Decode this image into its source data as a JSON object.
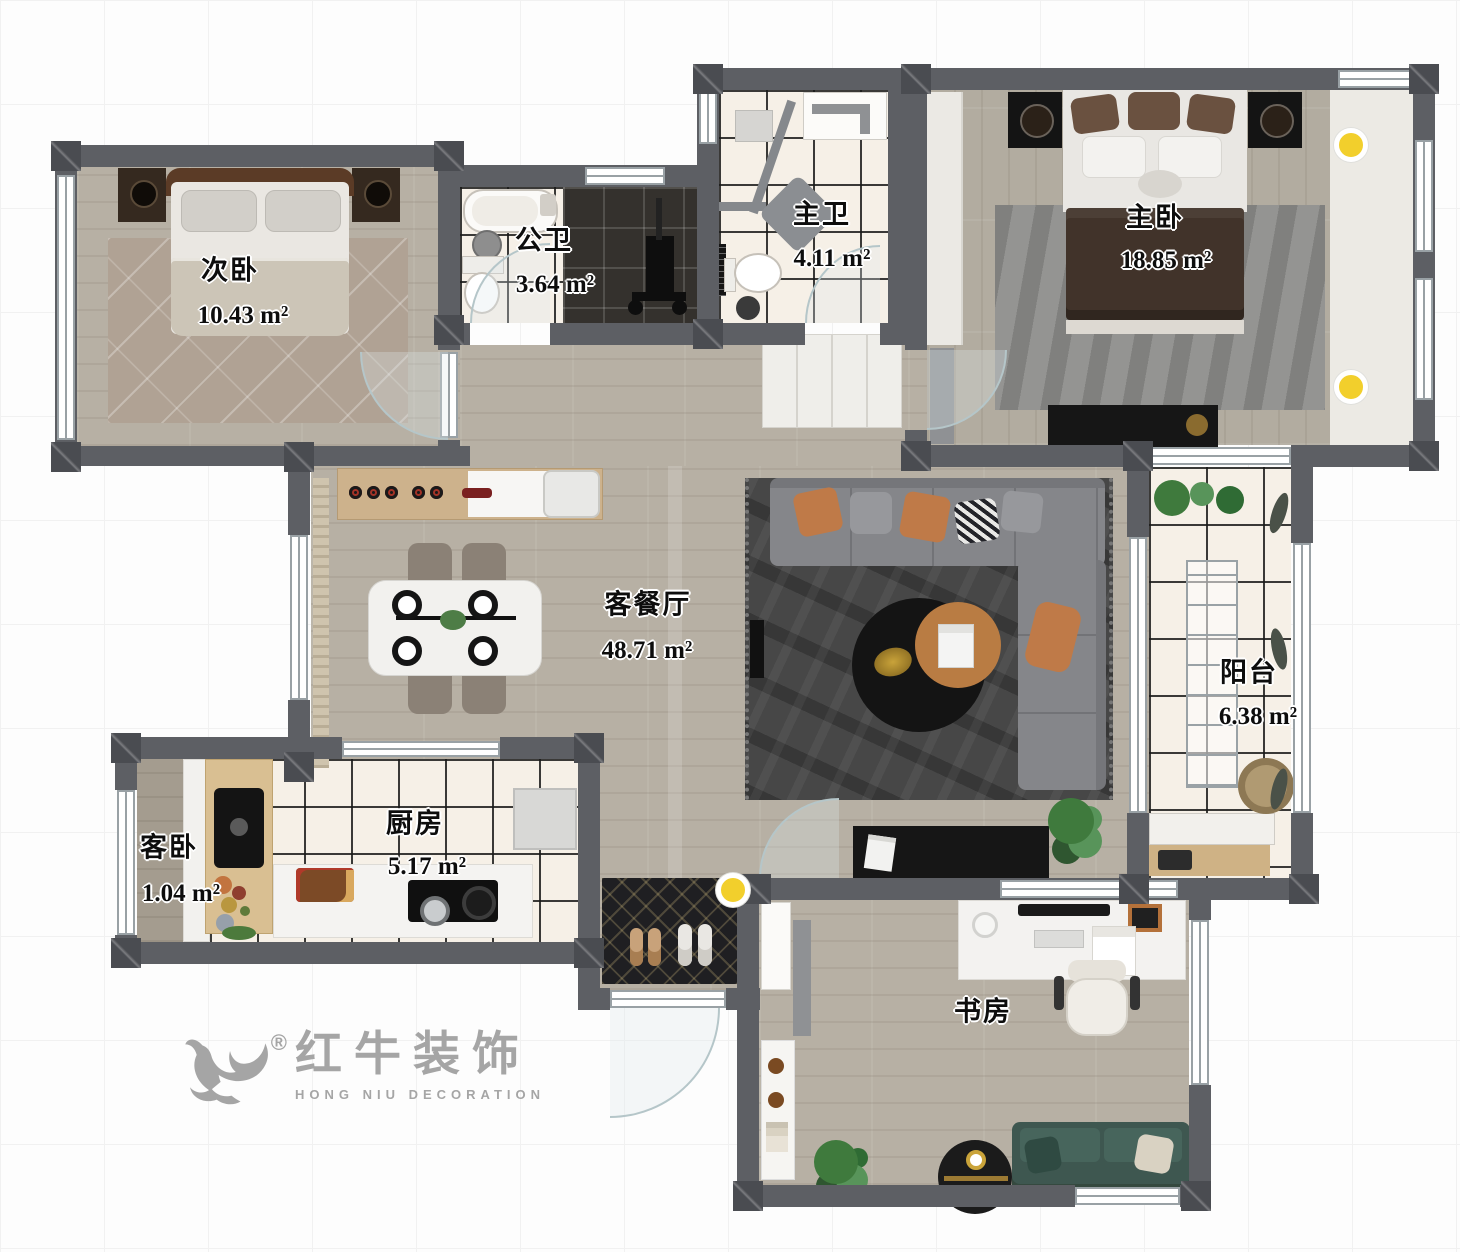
{
  "floorplan": {
    "rooms": [
      {
        "id": "secondary-bedroom",
        "name": "次卧",
        "area": "10.43 m²"
      },
      {
        "id": "public-bathroom",
        "name": "公卫",
        "area": "3.64 m²"
      },
      {
        "id": "master-bathroom",
        "name": "主卫",
        "area": "4.11 m²"
      },
      {
        "id": "master-bedroom",
        "name": "主卧",
        "area": "18.85 m²"
      },
      {
        "id": "living-dining",
        "name": "客餐厅",
        "area": "48.71 m²"
      },
      {
        "id": "balcony",
        "name": "阳台",
        "area": "6.38 m²"
      },
      {
        "id": "guest-bedroom",
        "name": "客卧",
        "area": "1.04 m²"
      },
      {
        "id": "kitchen",
        "name": "厨房",
        "area": "5.17 m²"
      },
      {
        "id": "study",
        "name": "书房",
        "area": ""
      }
    ],
    "logo": {
      "registered": "®",
      "title_cn": "红牛装饰",
      "title_en": "HONG NIU DECORATION"
    },
    "colors": {
      "wall": "#5d5f64",
      "accent_yellow": "#f2cf2c",
      "tile_line": "#191919"
    }
  }
}
